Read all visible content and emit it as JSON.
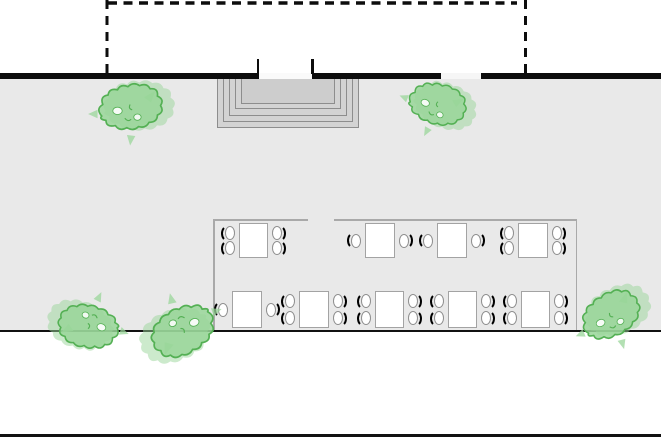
{
  "canvas": {
    "width": 661,
    "height": 440,
    "background": "#ffffff"
  },
  "colors": {
    "wall": "#0d0d0d",
    "terrace": "#e9e9e9",
    "step_fill": "#d3d3d3",
    "step_landing": "#cdcdcd",
    "step_border": "#8d8d8d",
    "boundary": "#a9a9a9",
    "table_fill": "#ffffff",
    "table_border": "#a3a3a3",
    "chair_arc": "#000000",
    "bush_fill": "#99d699",
    "bush_stroke": "#54b054",
    "edge_line": "#111111"
  },
  "building": {
    "dashed_outline": {
      "left_x": 107,
      "right_x": 525.5,
      "top_y": 3,
      "bottom_y": 73,
      "h_x1": 108,
      "h_x2": 517,
      "dash": "9 6.5",
      "thickness": 3.4
    },
    "wall": {
      "y": 73,
      "height": 6,
      "segments": [
        [
          0,
          259
        ],
        [
          312,
          441
        ],
        [
          481,
          661
        ]
      ],
      "openings": [
        {
          "x": 259,
          "w": 53,
          "fill": "#fafafa"
        },
        {
          "x": 441,
          "w": 40,
          "fill": "#f6f6f6"
        }
      ],
      "ticks": [
        {
          "x": 256.5
        },
        {
          "x": 311
        }
      ],
      "tick_y": 59,
      "tick_h": 14.5,
      "tick_w": 2.5
    }
  },
  "terrace": {
    "x": 0,
    "y": 79,
    "w": 661,
    "h": 252,
    "edge_line_y": 330,
    "edge_line_h": 2,
    "page_line_y": 434,
    "page_line_h": 2.5
  },
  "entrance_steps": {
    "x": 217,
    "y": 79,
    "w": 142,
    "rings": [
      {
        "inset": 0,
        "h": 49
      },
      {
        "inset": 6,
        "h": 43
      },
      {
        "inset": 12,
        "h": 36.5
      },
      {
        "inset": 18,
        "h": 30
      }
    ],
    "landing": {
      "inset": 24,
      "h": 24.5
    }
  },
  "seating_area": {
    "boundary": {
      "left_x": 213,
      "right_x": 575.5,
      "top_y": 219,
      "bottom_y": 331,
      "top_segments": [
        [
          213,
          308
        ],
        [
          334,
          577
        ]
      ],
      "thickness": 1.5
    },
    "chair": {
      "w": 13,
      "h": 15
    },
    "tables": [
      {
        "id": "A1",
        "x": 239,
        "y": 223,
        "w": 29,
        "h": 35,
        "seats_per_side": 2
      },
      {
        "id": "A2",
        "x": 365,
        "y": 223,
        "w": 30,
        "h": 35,
        "seats_per_side": 1
      },
      {
        "id": "A3",
        "x": 437,
        "y": 223,
        "w": 30,
        "h": 35,
        "seats_per_side": 1
      },
      {
        "id": "A4",
        "x": 518,
        "y": 223,
        "w": 30,
        "h": 35,
        "seats_per_side": 2
      },
      {
        "id": "B1",
        "x": 232,
        "y": 291,
        "w": 30,
        "h": 37,
        "seats_per_side": 1
      },
      {
        "id": "B2",
        "x": 299,
        "y": 291,
        "w": 30,
        "h": 37,
        "seats_per_side": 2
      },
      {
        "id": "B3",
        "x": 375,
        "y": 291,
        "w": 29,
        "h": 37,
        "seats_per_side": 2
      },
      {
        "id": "B4",
        "x": 448,
        "y": 291,
        "w": 29,
        "h": 37,
        "seats_per_side": 2
      },
      {
        "id": "B5",
        "x": 521,
        "y": 291,
        "w": 29,
        "h": 37,
        "seats_per_side": 2
      }
    ]
  },
  "bushes": [
    {
      "cx": 128,
      "cy": 114,
      "scale": 1.05,
      "rotate": 0
    },
    {
      "cx": 433,
      "cy": 109,
      "scale": 0.95,
      "rotate": 22
    },
    {
      "cx": 93,
      "cy": 321,
      "scale": 1.0,
      "rotate": 200
    },
    {
      "cx": 183,
      "cy": 323,
      "scale": 1.08,
      "rotate": 160
    },
    {
      "cx": 611,
      "cy": 322,
      "scale": 1.0,
      "rotate": 338
    }
  ]
}
